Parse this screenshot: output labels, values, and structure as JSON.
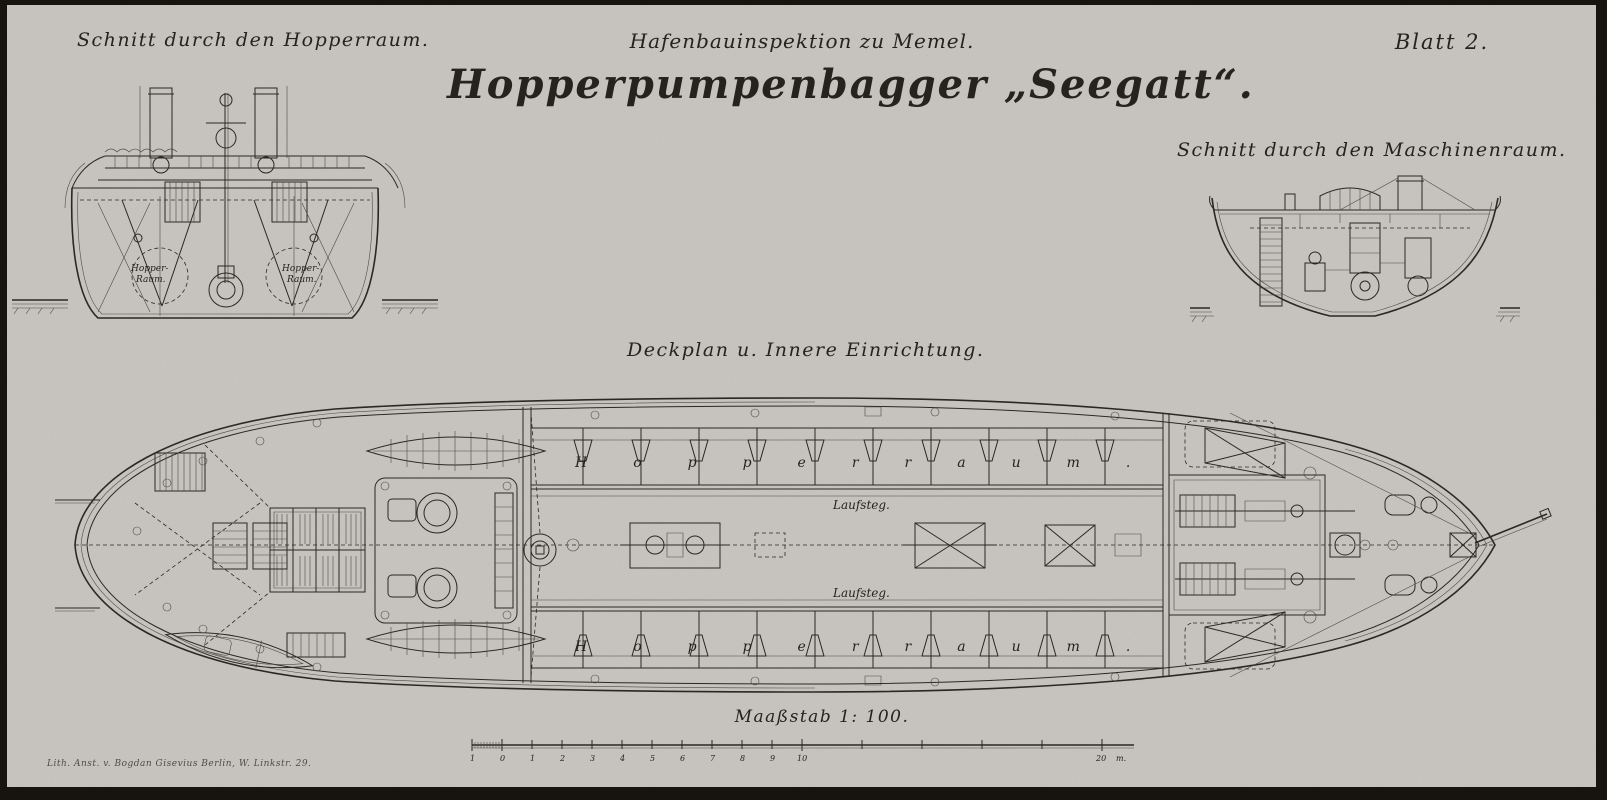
{
  "header": {
    "institution": "Hafenbauinspektion zu Memel.",
    "main_title": "Hopperpumpenbagger „Seegatt“.",
    "sheet_label": "Blatt 2."
  },
  "sections": {
    "hopper_title": "Schnitt durch den Hopperraum.",
    "machine_title": "Schnitt durch den Maschinenraum.",
    "deckplan_title": "Deckplan u. Innere Einrichtung."
  },
  "hopper_section": {
    "left_room": [
      "Hopper-",
      "Raum."
    ],
    "right_room": [
      "Hopper-",
      "Raum."
    ]
  },
  "deckplan": {
    "hopper_top_label": "Hopperraum.",
    "hopper_bottom_label": "Hopperraum.",
    "walkway_top_label": "Laufsteg.",
    "walkway_bottom_label": "Laufsteg."
  },
  "scalebar": {
    "title": "Maaßstab 1: 100.",
    "ticks": [
      "1",
      "0",
      "1",
      "2",
      "3",
      "4",
      "5",
      "6",
      "7",
      "8",
      "9",
      "10",
      "20"
    ],
    "unit": "m."
  },
  "imprint": {
    "text": "Lith. Anst. v. Bogdan Gisevius Berlin, W. Linkstr. 29."
  },
  "colors": {
    "paper": "#c9c6c2",
    "ink": "#2b2822",
    "frame": "#17140f"
  }
}
